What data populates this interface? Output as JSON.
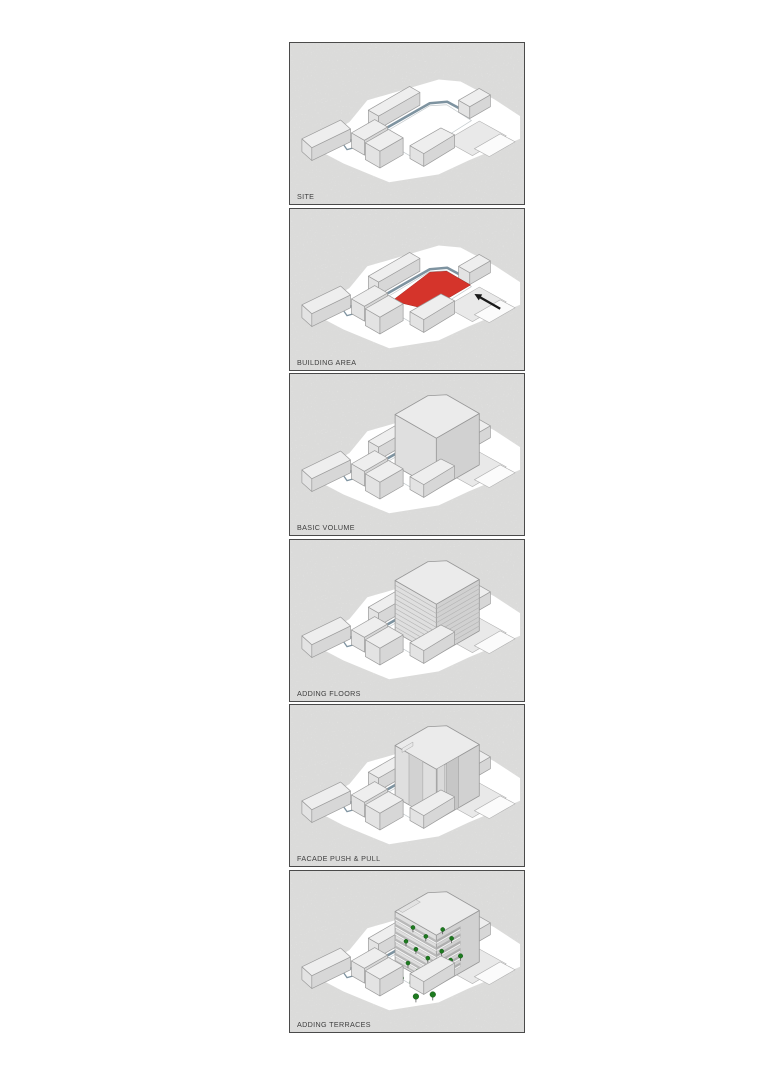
{
  "diagram": {
    "panels": [
      {
        "id": "site",
        "label": "SITE"
      },
      {
        "id": "building-area",
        "label": "BUILDING AREA"
      },
      {
        "id": "basic-volume",
        "label": "BASIC VOLUME"
      },
      {
        "id": "adding-floors",
        "label": "ADDING FLOORS"
      },
      {
        "id": "facade-push-pull",
        "label": "FACADE PUSH & PULL"
      },
      {
        "id": "adding-terraces",
        "label": "ADDING TERRACES"
      }
    ],
    "colors": {
      "panel_background": "#f2f2f1",
      "panel_border": "#4a4a4a",
      "label_text": "#3e3e3e",
      "building_area_red": "#d5342b",
      "road_blue_grey": "#7e93a0",
      "tree_green": "#1d7a1f",
      "massing_grey": "#dfdfdf",
      "arrow_black": "#1a1a1a"
    }
  }
}
